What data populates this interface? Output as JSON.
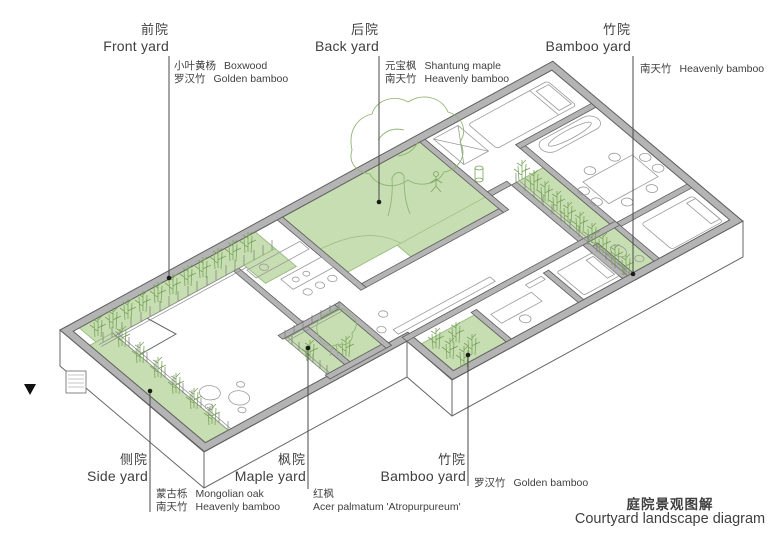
{
  "diagram": {
    "title": {
      "zh": "庭院景观图解",
      "en": "Courtyard landscape diagram"
    },
    "yards": [
      {
        "id": "front-yard",
        "zh": "前院",
        "en": "Front yard",
        "plants": [
          {
            "zh": "小叶黄杨",
            "en": "Boxwood"
          },
          {
            "zh": "罗汉竹",
            "en": "Golden bamboo"
          }
        ]
      },
      {
        "id": "back-yard",
        "zh": "后院",
        "en": "Back yard",
        "plants": [
          {
            "zh": "元宝枫",
            "en": "Shantung maple"
          },
          {
            "zh": "南天竹",
            "en": "Heavenly bamboo"
          }
        ]
      },
      {
        "id": "bamboo-yard-top",
        "zh": "竹院",
        "en": "Bamboo yard",
        "plants": [
          {
            "zh": "南天竹",
            "en": "Heavenly bamboo"
          }
        ]
      },
      {
        "id": "side-yard",
        "zh": "侧院",
        "en": "Side yard",
        "plants": [
          {
            "zh": "蒙古栎",
            "en": "Mongolian oak"
          },
          {
            "zh": "南天竹",
            "en": "Heavenly bamboo"
          }
        ]
      },
      {
        "id": "maple-yard",
        "zh": "枫院",
        "en": "Maple yard",
        "plants": [
          {
            "zh": "红枫",
            "en": "Acer palmatum 'Atropurpureum'"
          }
        ]
      },
      {
        "id": "bamboo-yard-bottom",
        "zh": "竹院",
        "en": "Bamboo yard",
        "plants": [
          {
            "zh": "罗汉竹",
            "en": "Golden bamboo"
          }
        ]
      }
    ],
    "colors": {
      "courtyard_green": "#c7deb2",
      "plant_green": "#7aa45c",
      "wall_gray": "#b4b4b4",
      "line_dark": "#404040"
    }
  }
}
